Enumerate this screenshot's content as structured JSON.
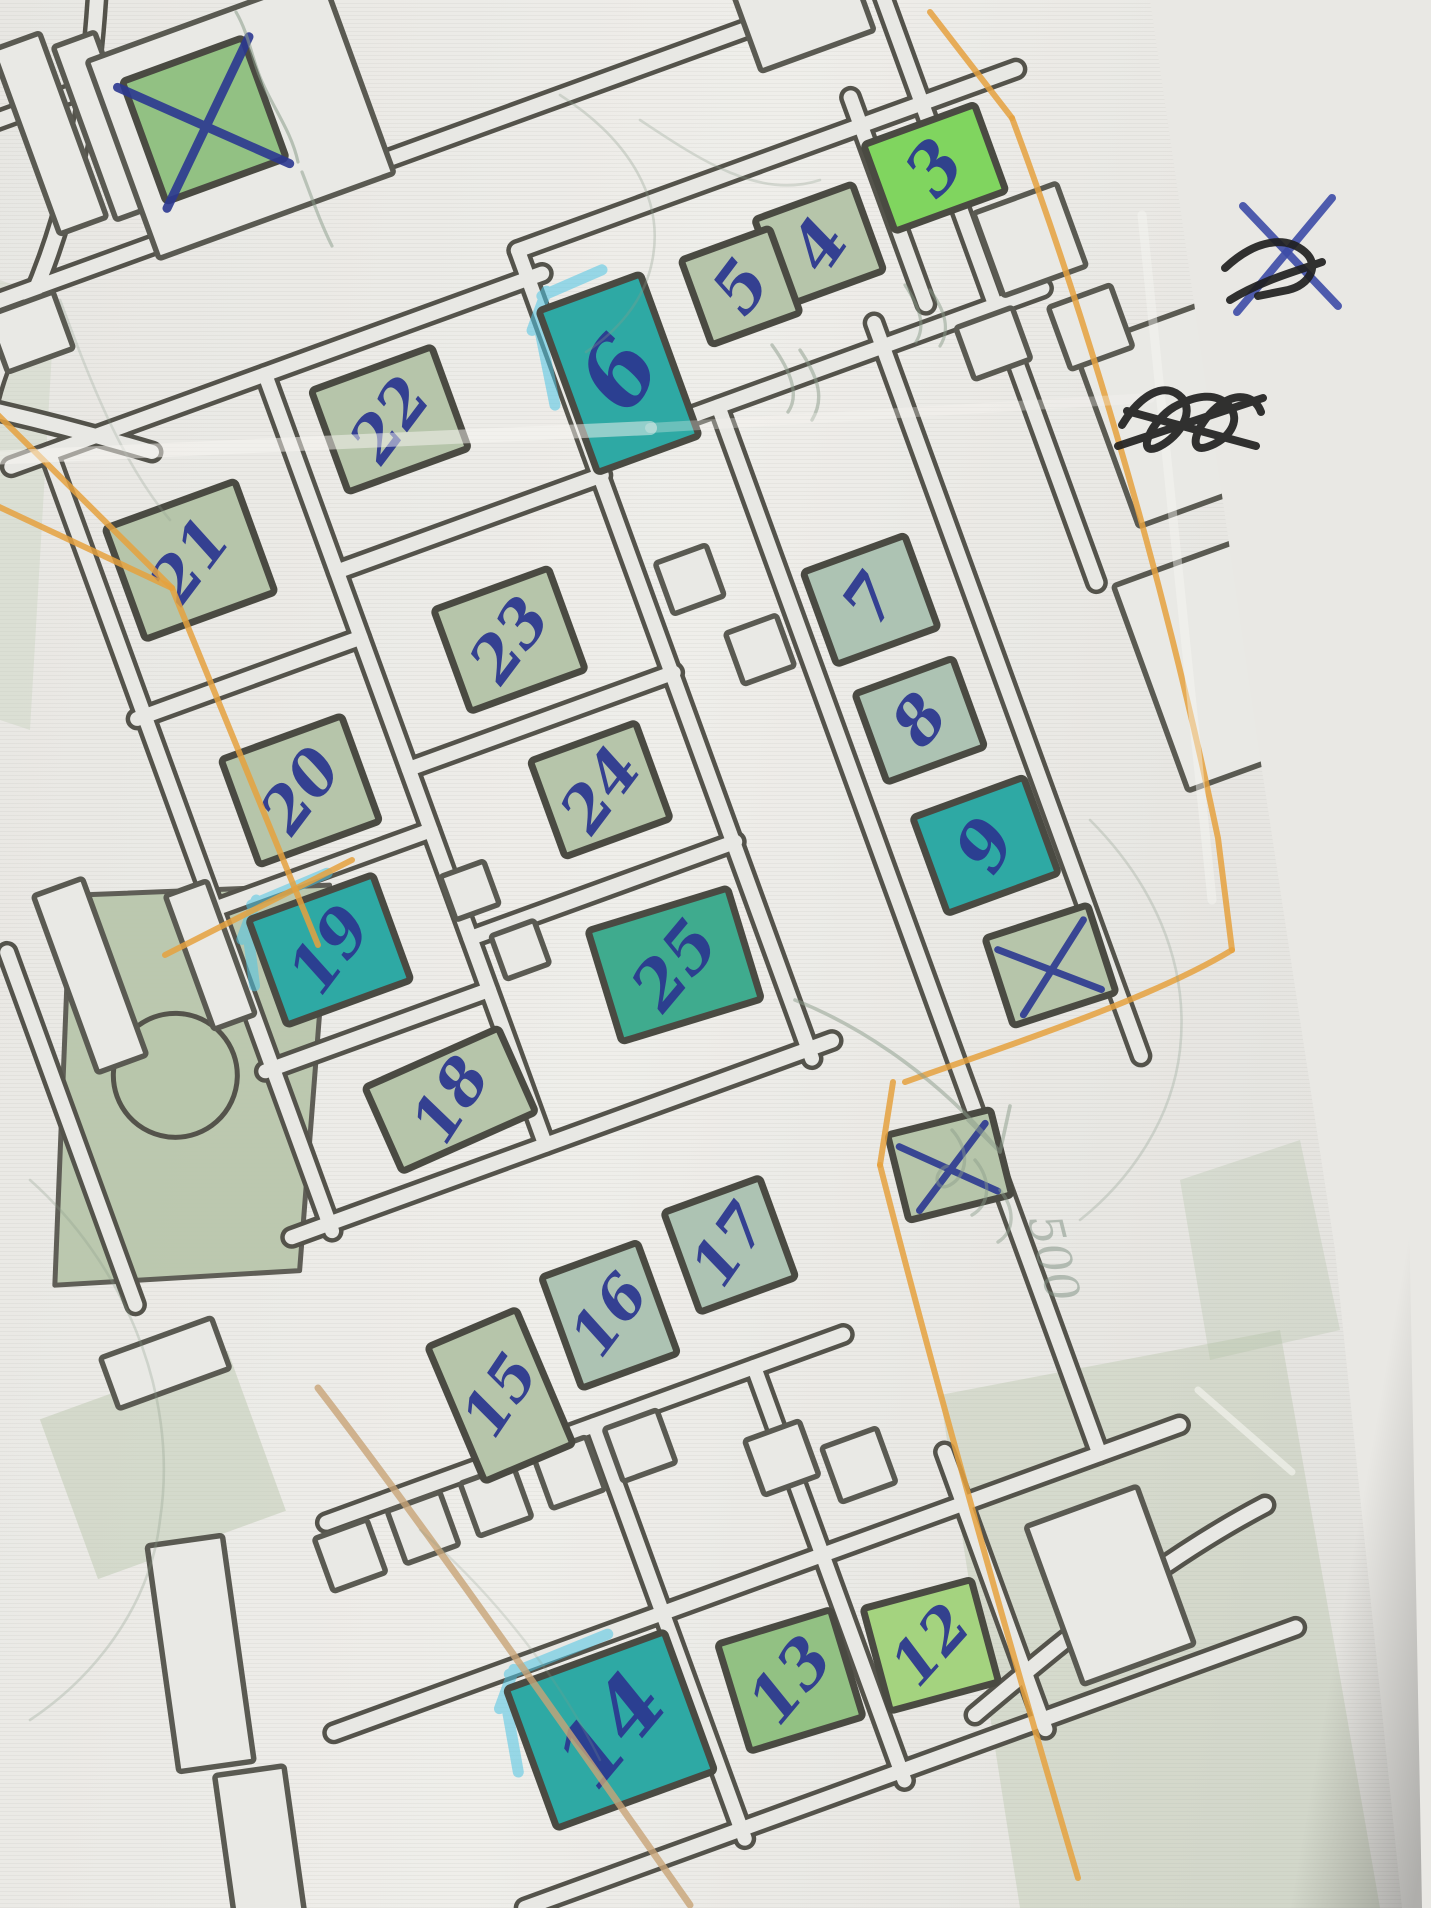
{
  "photo": {
    "table_color": "#38291f",
    "paper_color": "#e9e8e4",
    "kind": "hand-annotated printed street map"
  },
  "map": {
    "ink_color": "#2b3790",
    "street_color": "#54534b",
    "orange_color": "#e5a13e",
    "tan_color": "#c8a477",
    "pencil_color": "#8a9c8a",
    "cyan_color": "#4fc4e3",
    "fills": {
      "sage": "#b6c5aa",
      "sage2": "#adc3b3",
      "green": "#92c183",
      "bright_green": "#80d55f",
      "teal": "#2ea9a4",
      "teal_green": "#3fab8e",
      "light_green": "#a4d37f",
      "park": "#b8c6ab"
    },
    "buildings": [
      {
        "label": "3",
        "x": 670,
        "y": -365,
        "w": 118,
        "h": 92,
        "fill": "bright_green",
        "fs": 68,
        "tr": -30
      },
      {
        "label": "4",
        "x": 535,
        "y": -332,
        "w": 104,
        "h": 92,
        "fill": "sage",
        "fs": 66,
        "tr": -35
      },
      {
        "label": "5",
        "x": 447,
        "y": -320,
        "w": 94,
        "h": 90,
        "fill": "sage",
        "fs": 66,
        "tr": -33
      },
      {
        "label": "6",
        "x": 303,
        "y": -280,
        "w": 108,
        "h": 172,
        "fill": "teal",
        "fs": 92,
        "tr": -38,
        "highlight": true
      },
      {
        "label": "7",
        "x": 462,
        "y": 19,
        "w": 108,
        "h": 98,
        "fill": "sage2",
        "fs": 64,
        "tr": -35
      },
      {
        "label": "8",
        "x": 467,
        "y": 149,
        "w": 104,
        "h": 94,
        "fill": "sage2",
        "fs": 64,
        "tr": -33
      },
      {
        "label": "9",
        "x": 486,
        "y": 289,
        "w": 118,
        "h": 102,
        "fill": "teal",
        "fs": 68,
        "tr": -40
      },
      {
        "label": "",
        "x": 506,
        "y": 424,
        "w": 108,
        "h": 92,
        "fill": "sage",
        "crossed": true,
        "r": 2
      },
      {
        "label": "",
        "x": 343,
        "y": 577,
        "w": 106,
        "h": 88,
        "fill": "sage",
        "crossed": true,
        "r": 6
      },
      {
        "label": "",
        "x": 0,
        "y": -660,
        "w": 128,
        "h": 128,
        "fill": "green",
        "crossed": true,
        "bigx": true
      },
      {
        "label": "22",
        "x": 72,
        "y": -315,
        "w": 128,
        "h": 108,
        "fill": "sage",
        "fs": 62,
        "tr": -33
      },
      {
        "label": "21",
        "x": -164,
        "y": -251,
        "w": 138,
        "h": 118,
        "fill": "sage",
        "fs": 62,
        "tr": -33
      },
      {
        "label": "23",
        "x": 109,
        "y": -67,
        "w": 122,
        "h": 108,
        "fill": "sage",
        "fs": 62,
        "tr": -33
      },
      {
        "label": "20",
        "x": -139,
        "y": 3,
        "w": 128,
        "h": 112,
        "fill": "sage",
        "fs": 62,
        "tr": -33
      },
      {
        "label": "24",
        "x": 143,
        "y": 105,
        "w": 112,
        "h": 102,
        "fill": "sage",
        "fs": 62,
        "tr": -33
      },
      {
        "label": "19",
        "x": -166,
        "y": 163,
        "w": 132,
        "h": 112,
        "fill": "teal",
        "fs": 64,
        "tr": -33,
        "highlight": true
      },
      {
        "label": "25",
        "x": 153,
        "y": 295,
        "w": 146,
        "h": 116,
        "fill": "teal_green",
        "fs": 66,
        "tr": -33,
        "r": 3
      },
      {
        "label": "18",
        "x": -104,
        "y": 345,
        "w": 146,
        "h": 92,
        "fill": "sage",
        "fs": 62,
        "tr": -33,
        "r": -4
      },
      {
        "label": "17",
        "x": 109,
        "y": 577,
        "w": 102,
        "h": 106,
        "fill": "sage2",
        "fs": 60,
        "tr": -35
      },
      {
        "label": "16",
        "x": -28,
        "y": 602,
        "w": 102,
        "h": 118,
        "fill": "sage2",
        "fs": 60,
        "tr": -33
      },
      {
        "label": "15",
        "x": -158,
        "y": 640,
        "w": 96,
        "h": 146,
        "fill": "sage",
        "fs": 60,
        "tr": -33,
        "r": -3
      },
      {
        "label": "12",
        "x": 161,
        "y": 1022,
        "w": 112,
        "h": 106,
        "fill": "light_green",
        "fs": 60,
        "tr": -33,
        "r": 5
      },
      {
        "label": "13",
        "x": 17,
        "y": 1007,
        "w": 118,
        "h": 112,
        "fill": "green",
        "fs": 64,
        "tr": -33,
        "r": 3
      },
      {
        "label": "14",
        "x": -169,
        "y": 992,
        "w": 168,
        "h": 148,
        "fill": "teal",
        "fs": 84,
        "tr": -30,
        "highlight": true
      }
    ],
    "pencil_note": {
      "text": "500",
      "x": 1054,
      "y": 1258,
      "rot": 76,
      "fs": 46
    }
  },
  "artwork": {
    "rot": "translate(430,740) rotate(-20)",
    "cover_points": "1150,0 1431,0 1431,1908 1402,1908 1335,1250 1262,770",
    "streets_local": [
      "M -300,-400 L 265,-400",
      "M -268,-120 L -30,-120",
      "M -268,85 L -30,85",
      "M -268,255 L -30,255",
      "M -30,-190 L 252,-190",
      "M -30,20 L 252,20",
      "M -30,200 L 252,200",
      "M -300,420 L 275,420",
      "M -365,700 L 185,700",
      "M -430,900 L 470,900",
      "M -310,1130 L 510,1130",
      "M -310,-560 L 810,-560",
      "M 250,-430 L 780,-430",
      "M 250,-215 L 730,-215",
      "M -260,-400 L -260,428",
      "M -30,-400 L -30,420",
      "M 250,-430 L 250,430",
      "M 385,-215 L 385,900",
      "M 560,-240 L 560,540",
      "M 680,-560 L 680,80",
      "M 615,-460 L 615,-240",
      "M 110,-905 L 110,-560",
      "M -80,700 L -80,1140",
      "M 90,700 L 90,1140",
      "M 240,845 L 240,1140",
      "M -470,55 L -470,430",
      "M -310,-730 L 110,-730"
    ],
    "streets_orig": [
      "M 98,-20 C 90,130 62,245 12,340",
      "M 12,340 C 0,362 -8,385 -14,415",
      "M -16,408 C 55,424 105,438 152,452",
      "M 975,1715 C 1070,1635 1160,1560 1265,1505"
    ],
    "lots": [
      "M 492,-380 L 492,-272",
      "M -30,-608 L 100,-608"
    ],
    "outlines": [
      [
        -354,
        739,
        56,
        56,
        0,
        1
      ],
      [
        -276,
        738,
        56,
        56,
        0,
        1
      ],
      [
        -198,
        737,
        56,
        56,
        0,
        1
      ],
      [
        -120,
        736,
        56,
        56,
        0,
        1
      ],
      [
        -44,
        735,
        56,
        56,
        0,
        1
      ],
      [
        -14,
        155,
        46,
        46,
        0,
        1
      ],
      [
        13,
        228,
        46,
        46,
        0,
        1
      ],
      [
        299,
        -62,
        54,
        54,
        0,
        1
      ],
      [
        341,
        28,
        54,
        54,
        0,
        1
      ],
      [
        85,
        795,
        58,
        58,
        0,
        1
      ],
      [
        155,
        828,
        58,
        58,
        0,
        1
      ],
      [
        -400,
        105,
        52,
        188,
        0,
        1
      ],
      [
        -280,
        127,
        44,
        142,
        0,
        1
      ],
      [
        -150,
        -700,
        50,
        196,
        0,
        1
      ],
      [
        -95,
        -688,
        44,
        184,
        0,
        1
      ],
      [
        823,
        -52,
        168,
        188,
        0,
        1
      ],
      [
        779,
        198,
        168,
        218,
        0,
        1
      ],
      [
        350,
        1027,
        118,
        168,
        0,
        1
      ],
      [
        735,
        -265,
        88,
        88,
        0,
        1
      ],
      [
        762,
        -162,
        66,
        66,
        0,
        1
      ],
      [
        665,
        -180,
        60,
        55,
        0,
        1
      ],
      [
        -528,
        780,
        76,
        228,
        12,
        1
      ],
      [
        -539,
        985,
        70,
        160,
        12,
        1
      ],
      [
        -462,
        495,
        118,
        54,
        0,
        1
      ],
      [
        35,
        -650,
        250,
        210,
        0,
        0
      ],
      [
        -236,
        -520,
        70,
        60,
        0,
        1
      ],
      [
        600,
        -560,
        120,
        90,
        0,
        1
      ]
    ],
    "park": {
      "body": "M -391,23 L -144,102 L -304,454 L -539,384 Z",
      "circle": [
        -354,
        228,
        62
      ],
      "patch2": [
        -599,
        505,
        200,
        170
      ]
    },
    "washes": [
      {
        "pts": "0,280 55,300 30,730 0,720",
        "fill": "#c2cdb8",
        "o": 0.35
      },
      {
        "pts": "940,1395 1280,1330 1380,1908 1020,1908",
        "fill": "#aebfa0",
        "o": 0.32
      },
      {
        "pts": "1180,1180 1300,1140 1340,1330 1210,1360",
        "fill": "#aebfa0",
        "o": 0.28
      }
    ],
    "orange": [
      "M -5,412 L 172,588",
      "M -5,505 L 172,588",
      "M 172,588 L 318,945",
      "M 165,955 L 352,860",
      "M 930,12 L 1012,118",
      "M 1012,118 C 1080,300 1160,560 1218,838 L 1232,950",
      "M 1232,950 C 1150,1000 1000,1048 905,1082",
      "M 893,1082 L 880,1165",
      "M 880,1165 C 940,1400 1020,1680 1078,1878"
    ],
    "tan": [
      "M 318,1388 C 420,1520 560,1720 690,1905"
    ],
    "pencil": [
      {
        "d": "M 236,12 C 250,36 252,62 264,86 C 276,112 292,134 298,162",
        "w": 3.2,
        "o": 0.55
      },
      {
        "d": "M 302,172 C 312,198 320,222 332,246",
        "w": 3.2,
        "o": 0.5
      },
      {
        "d": "M 560,95 C 630,140 665,200 652,262 C 644,302 616,332 586,352",
        "w": 2.6,
        "o": 0.3
      },
      {
        "d": "M 640,120 C 700,160 760,200 820,180",
        "w": 2.6,
        "o": 0.28
      },
      {
        "d": "M 772,345 C 790,370 800,395 788,412 M 800,350 C 820,380 824,400 812,420",
        "w": 3.4,
        "o": 0.5
      },
      {
        "d": "M 905,285 C 920,308 926,326 916,342 M 930,290 C 946,312 950,330 940,346",
        "w": 3.2,
        "o": 0.5
      },
      {
        "d": "M 795,1000 C 870,1030 945,1085 1000,1152 M 1000,1152 L 968,1120 M 1000,1152 L 1010,1106",
        "w": 3.6,
        "o": 0.5
      },
      {
        "d": "M 952,1130 C 970,1150 968,1175 950,1185 C 935,1193 932,1172 947,1166 M 975,1160 C 992,1180 990,1205 972,1215 M 1000,1190 C 1016,1210 1014,1232 998,1242",
        "w": 3.4,
        "o": 0.45
      },
      {
        "d": "M 30,1180 C 120,1260 180,1390 160,1520 C 150,1610 90,1680 30,1720",
        "w": 2.6,
        "o": 0.28
      },
      {
        "d": "M 1090,820 C 1150,880 1190,960 1180,1050 C 1172,1120 1130,1180 1080,1220",
        "w": 2.6,
        "o": 0.28
      },
      {
        "d": "M 60,300 C 90,380 120,460 170,520",
        "w": 2.6,
        "o": 0.25
      },
      {
        "d": "M 420,1530 C 500,1600 560,1680 600,1760",
        "w": 2.4,
        "o": 0.22
      }
    ],
    "creases": [
      {
        "d": "M -10,458 L 650,428",
        "o": 0.5,
        "w": 14
      },
      {
        "d": "M 650,428 L 1150,398",
        "o": 0.3,
        "w": 10
      },
      {
        "d": "M 1142,215 L 1212,900",
        "o": 0.45,
        "w": 9
      },
      {
        "d": "M 1198,1390 L 1292,1472",
        "o": 0.6,
        "w": 7
      }
    ],
    "margin": {
      "blue_x": [
        "M 1243,206 L 1338,306",
        "M 1332,198 L 1237,312"
      ],
      "black": [
        "M 1225,268 C 1255,240 1285,235 1305,252 C 1320,265 1310,285 1288,290 L 1258,296 M 1230,300 C 1262,280 1300,270 1322,262",
        "M 1122,425 C 1140,395 1165,380 1182,398 C 1196,414 1176,440 1156,448 C 1136,455 1152,420 1174,407 C 1196,395 1216,392 1229,406 C 1242,420 1229,440 1207,447 C 1185,454 1198,420 1221,404 C 1240,391 1256,398 1261,412 M 1118,446 L 1263,398 M 1127,411 L 1256,446"
      ]
    }
  }
}
